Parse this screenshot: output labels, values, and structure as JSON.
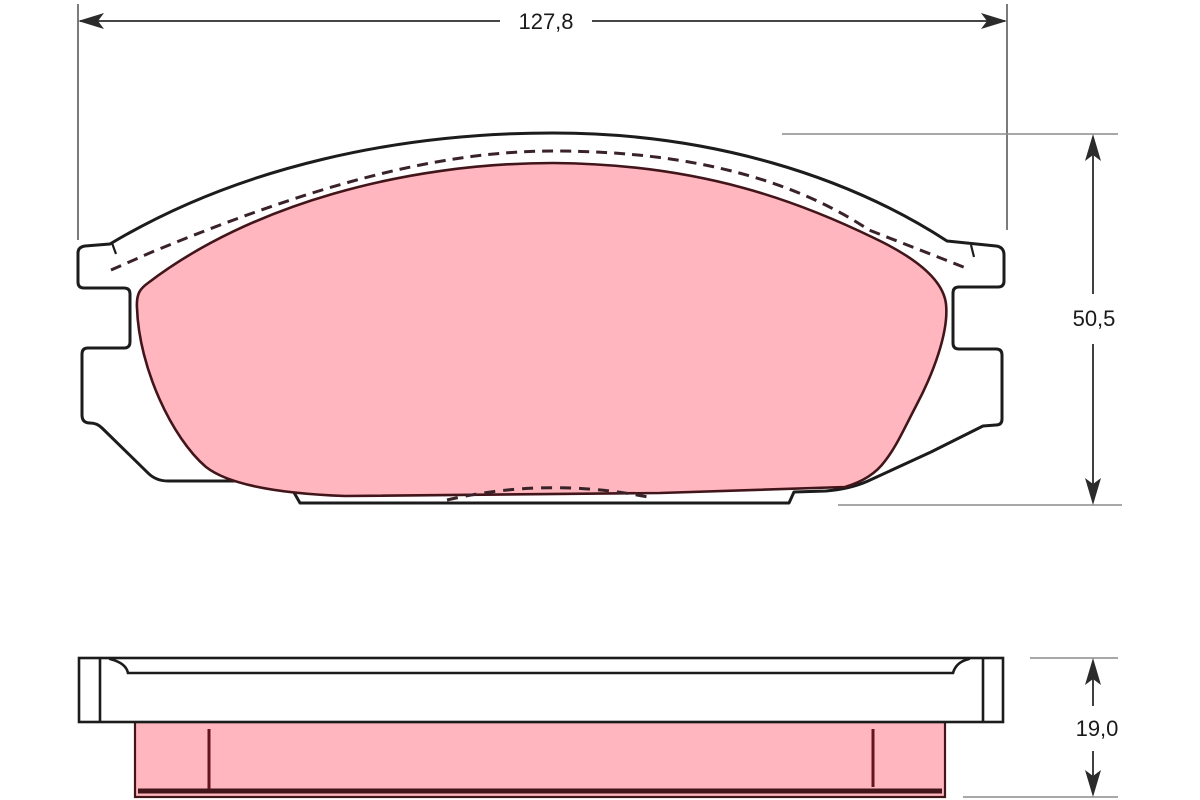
{
  "drawing": {
    "dimensions": {
      "width": {
        "label": "127,8"
      },
      "height": {
        "label": "50,5"
      },
      "thickness": {
        "label": "19,0"
      }
    },
    "colors": {
      "background": "#ffffff",
      "plate_fill": "#ffffff",
      "plate_outline": "#1c1c1c",
      "friction_fill": "#ffb6be",
      "friction_outline": "#42151b",
      "chamfer_dash": "#3a2328",
      "wear_mark": "#64141c",
      "dimension_line": "#2b2b2b",
      "extension_line": "#5a5a5a",
      "reference_line": "#8c8c8c",
      "label_text": "#1a1a1a"
    }
  }
}
